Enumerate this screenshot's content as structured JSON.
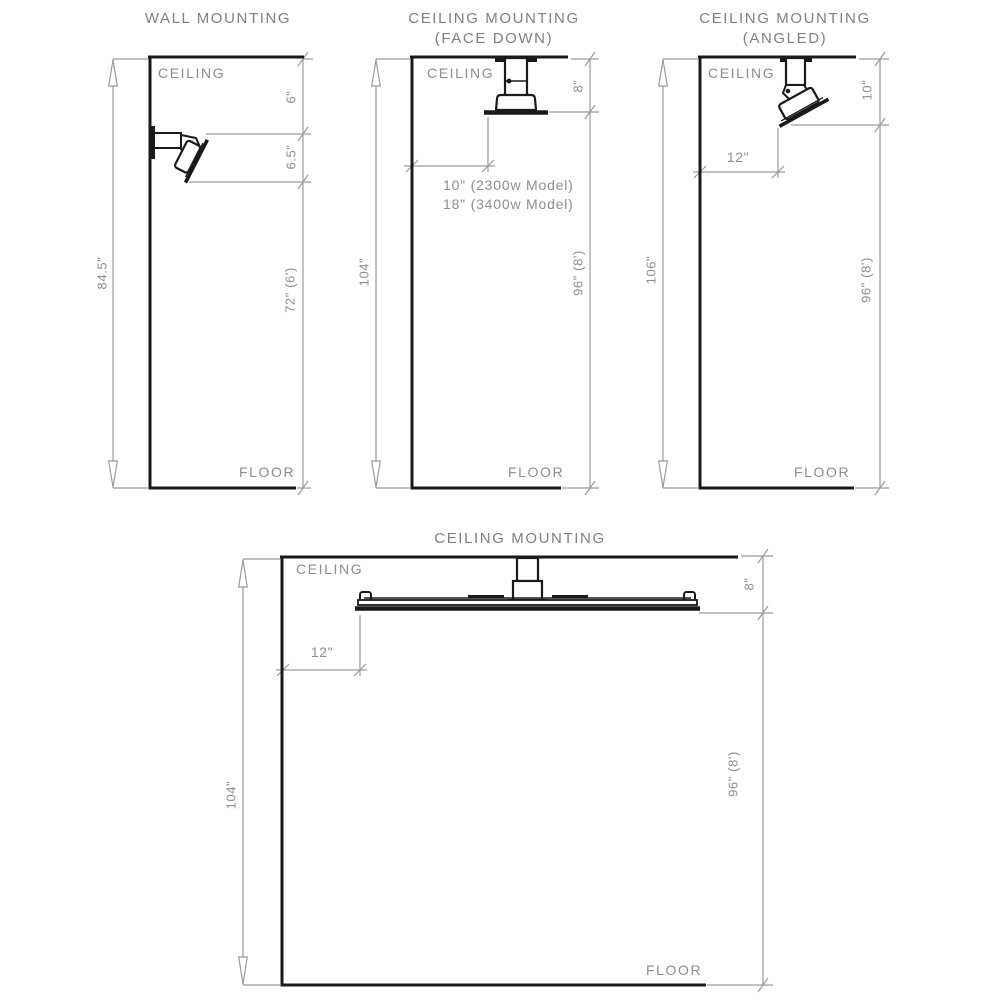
{
  "colors": {
    "structure_line": "#1a1a1a",
    "dimension_line": "#9b9b9b",
    "text": "#8b8e91"
  },
  "diagrams": {
    "wall_mount": {
      "title": "WALL MOUNTING",
      "ceiling": "CEILING",
      "floor": "FLOOR",
      "overall_height": "84.5\"",
      "ceiling_offset": "6\"",
      "fixture_span": "6.5\"",
      "floor_clearance": "72\" (6')"
    },
    "ceiling_face_down": {
      "title": "CEILING MOUNTING",
      "subtitle": "(FACE DOWN)",
      "ceiling": "CEILING",
      "floor": "FLOOR",
      "overall_height": "104\"",
      "drop": "8\"",
      "floor_clearance": "96\" (8')",
      "wall_offset_2300w": "10\" (2300w Model)",
      "wall_offset_3400w": "18\" (3400w Model)"
    },
    "ceiling_angled": {
      "title": "CEILING MOUNTING",
      "subtitle": "(ANGLED)",
      "ceiling": "CEILING",
      "floor": "FLOOR",
      "overall_height": "106\"",
      "drop": "10\"",
      "wall_offset": "12\"",
      "floor_clearance": "96\" (8')"
    },
    "ceiling_large": {
      "title": "CEILING MOUNTING",
      "ceiling": "CEILING",
      "floor": "FLOOR",
      "overall_height": "104\"",
      "drop": "8\"",
      "wall_offset": "12\"",
      "floor_clearance": "96\" (8')"
    }
  }
}
